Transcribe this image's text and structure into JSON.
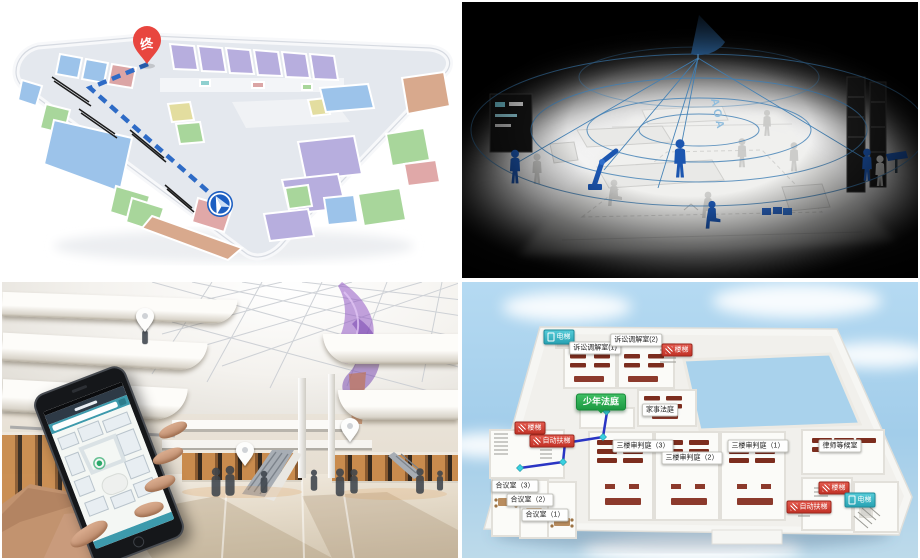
{
  "collage": {
    "mall_map": {
      "destination_pin": "终",
      "route_color": "#2e6bc6",
      "pin_color": "#e8463f",
      "room_colors": {
        "purple": "#b7aede",
        "blue": "#9cc3ea",
        "green": "#a8d69b",
        "salmon": "#d8a98d",
        "pink": "#e0a8a8",
        "yellow": "#e3dd9f",
        "corridor": "#e2e6ec"
      }
    },
    "aoa_scene": {
      "beacon_label": "AOA",
      "figure_blue": "#1c56b0",
      "beam_color": "#3f7fb5"
    },
    "mall_photo": {
      "pin_count": 3,
      "sculpture_color": "#9b6fc9",
      "phone_accent": "#3d9aac"
    },
    "court_map": {
      "route_color": "#2a35c4",
      "labels": {
        "elevator_top": "电梯",
        "mediation_room_1": "诉讼调解室(1)",
        "mediation_room_2": "诉讼调解室(2)",
        "stairs_top": "楼梯",
        "juvenile_court": "少年法庭",
        "family_court": "家事法庭",
        "stairs_left": "楼梯",
        "escalator_left": "自动扶梯",
        "trial_court_3": "三楼审判庭（3）",
        "trial_court_2": "三楼审判庭（2）",
        "trial_court_1": "三楼审判庭（1）",
        "lawyer_lounge": "律师等候室",
        "deliberation_room_3": "合议室（3）",
        "deliberation_room_2": "合议室（2）",
        "deliberation_room_1": "合议室（1）",
        "stairs_right": "楼梯",
        "escalator_right": "自动扶梯",
        "elevator_right": "电梯"
      }
    }
  }
}
